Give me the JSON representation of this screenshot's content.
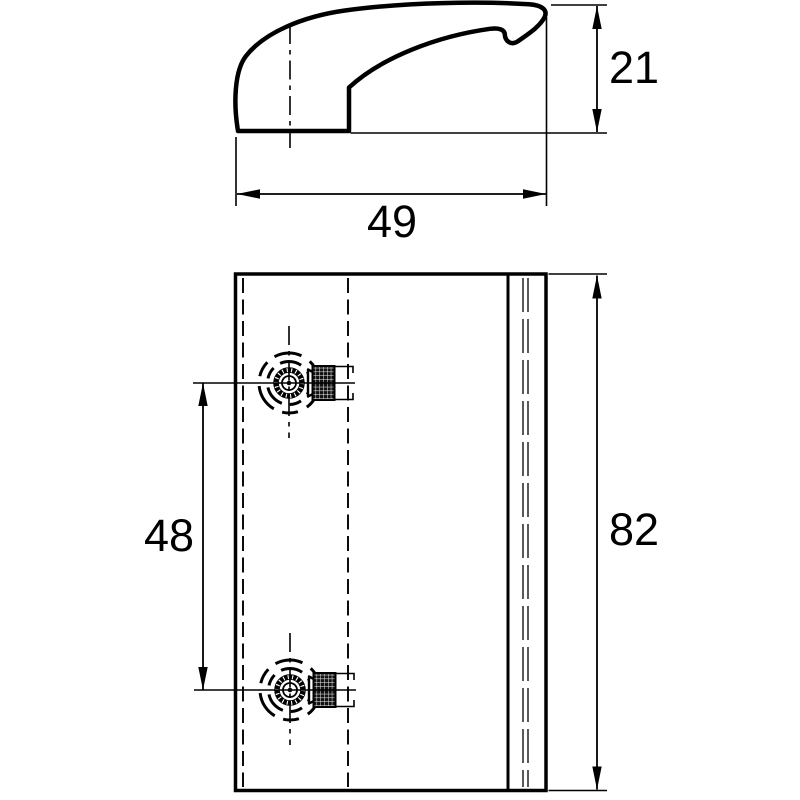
{
  "drawing": {
    "dimensions": {
      "profile_height": "21",
      "profile_width": "49",
      "hole_spacing": "48",
      "plate_height": "82"
    },
    "colors": {
      "line": "#000000",
      "background": "#ffffff"
    }
  }
}
